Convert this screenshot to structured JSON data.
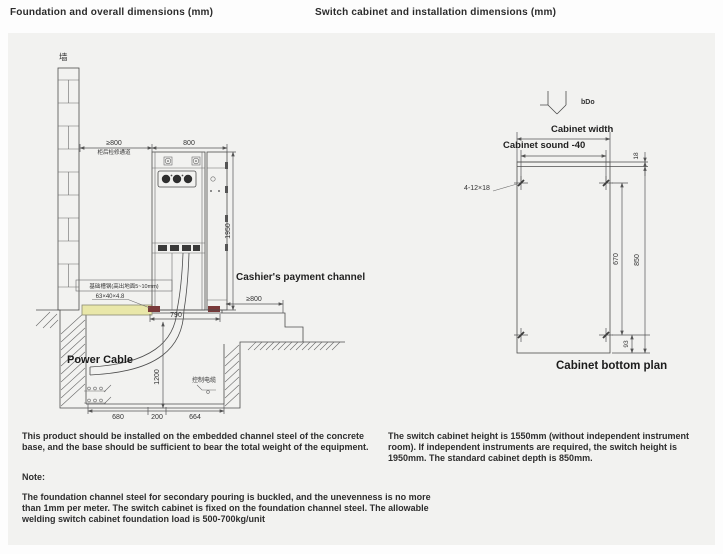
{
  "titles": {
    "left": "Foundation and overall dimensions (mm)",
    "right": "Switch cabinet and installation dimensions (mm)"
  },
  "foundation": {
    "wall_label": "墙",
    "rear_dim": "≥800",
    "rear_note": "柜后检修通道",
    "width_dim": "800",
    "height_dim": "1950",
    "steel_note": "基础槽钢(高出地面5~10mm)",
    "steel_size": "63×40×4.8",
    "payment_label": "Cashier's payment channel",
    "front_dim": "≥800",
    "base_dim": "790",
    "power_label": "Power Cable",
    "control_label": "控制电缆",
    "depth_dim": "1200",
    "pit_dims": [
      "680",
      "200",
      "664"
    ]
  },
  "plan": {
    "arrow_label": "bDo",
    "width_label": "Cabinet width",
    "sound_label": "Cabinet sound -40",
    "holes_label": "4-12×18",
    "dim18": "18",
    "dim670": "670",
    "dim850": "850",
    "dim93": "93",
    "caption": "Cabinet bottom plan"
  },
  "notes": {
    "para1": "This product should be installed on the embedded channel steel of the concrete base, and the base should be sufficient to bear the total weight of the equipment.",
    "note_label": "Note:",
    "para2": "The foundation channel steel for secondary pouring is buckled, and the unevenness is no more than 1mm per meter. The switch cabinet is fixed on the foundation channel steel. The allowable welding switch cabinet foundation load is 500-700kg/unit",
    "para3": "The switch cabinet height is 1550mm (without independent instrument room). If independent instruments are required, the switch height is 1950mm. The standard cabinet depth is 850mm."
  },
  "colors": {
    "panel_bg": "#f2f2f0",
    "line": "#4d4d4d",
    "channel_steel_fill": "#e9e7a9",
    "base_mark": "#7a3a3a"
  }
}
